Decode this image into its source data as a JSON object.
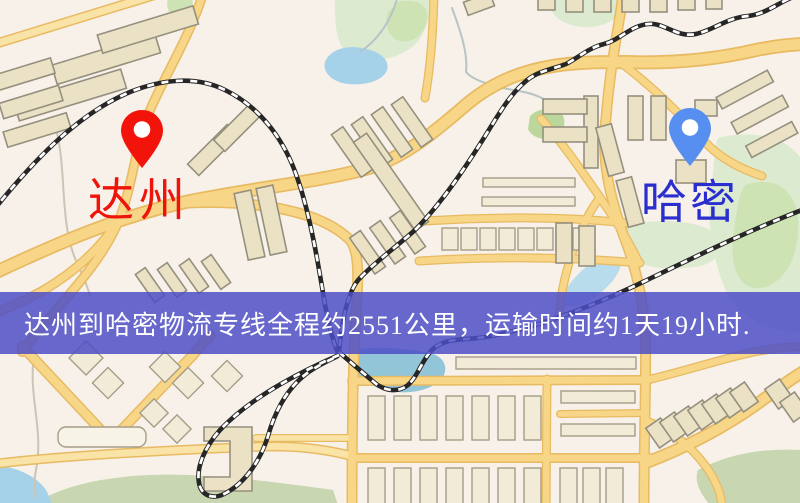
{
  "banner": {
    "text": "达州到哈密物流专线全程约2551公里，运输时间约1天19小时.",
    "bg_color": "rgba(77,79,199,0.85)",
    "text_color": "#ffffff"
  },
  "origin": {
    "name": "达州",
    "label_color": "#ee1409",
    "pin_color": "#f2140a",
    "pin_icon": "red-map-pin-icon"
  },
  "destination": {
    "name": "哈密",
    "label_color": "#2a2ecf",
    "pin_color": "#568ff0",
    "pin_icon": "blue-map-pin-icon"
  },
  "route": {
    "distance_km": "2551",
    "duration": "1天19小时"
  },
  "map_palette": {
    "background": "#f7f1ea",
    "road_fill": "#f7d687",
    "road_casing": "#e8ba62",
    "building_fill": "#ebe2c6",
    "building_stroke": "#95907e",
    "park_green": "#dcead0",
    "water_blue": "#a5d2e9",
    "railway_black": "#262626"
  }
}
